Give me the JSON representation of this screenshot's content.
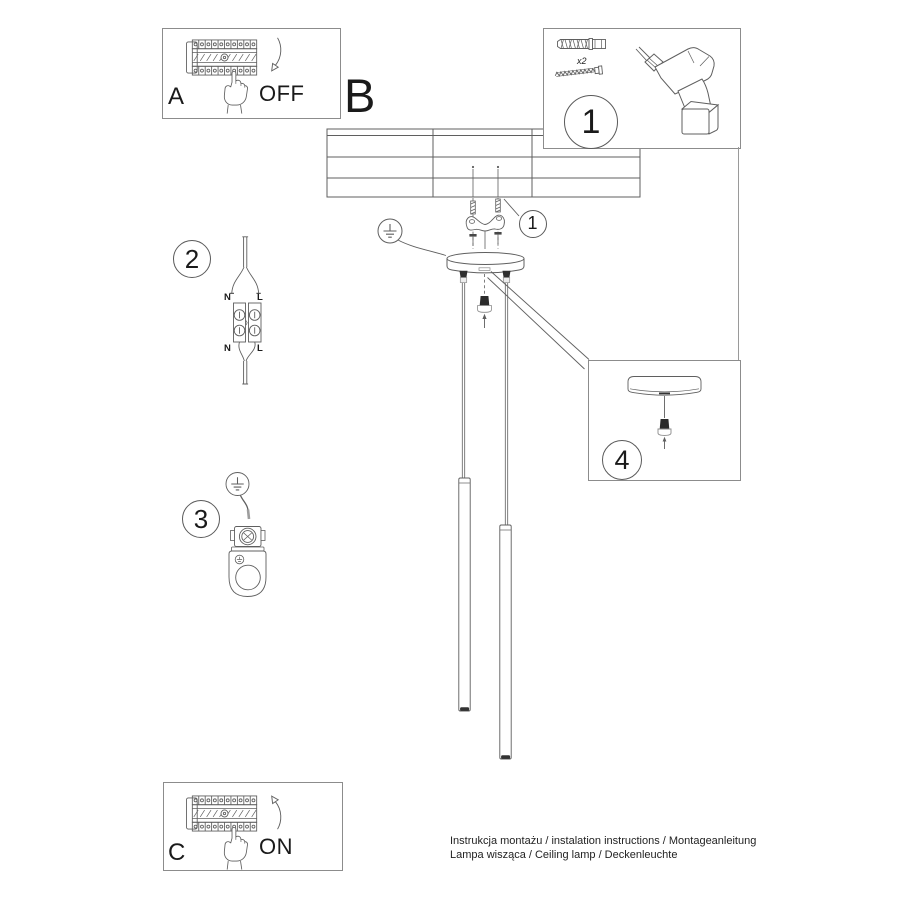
{
  "labels": {
    "panel_a": "A",
    "panel_b": "B",
    "panel_c": "C",
    "off": "OFF",
    "on": "ON"
  },
  "steps": {
    "kit": "1",
    "mount_callout": "1",
    "wiring": "2",
    "ground": "3",
    "detail": "4"
  },
  "kit": {
    "qty": "x2"
  },
  "wiring": {
    "n": "N",
    "l": "L"
  },
  "footer": {
    "line1": "Instrukcja montażu / instalation instructions / Montageanleitung",
    "line2": "Lampa wisząca / Ceiling lamp / Deckenleuchte"
  }
}
